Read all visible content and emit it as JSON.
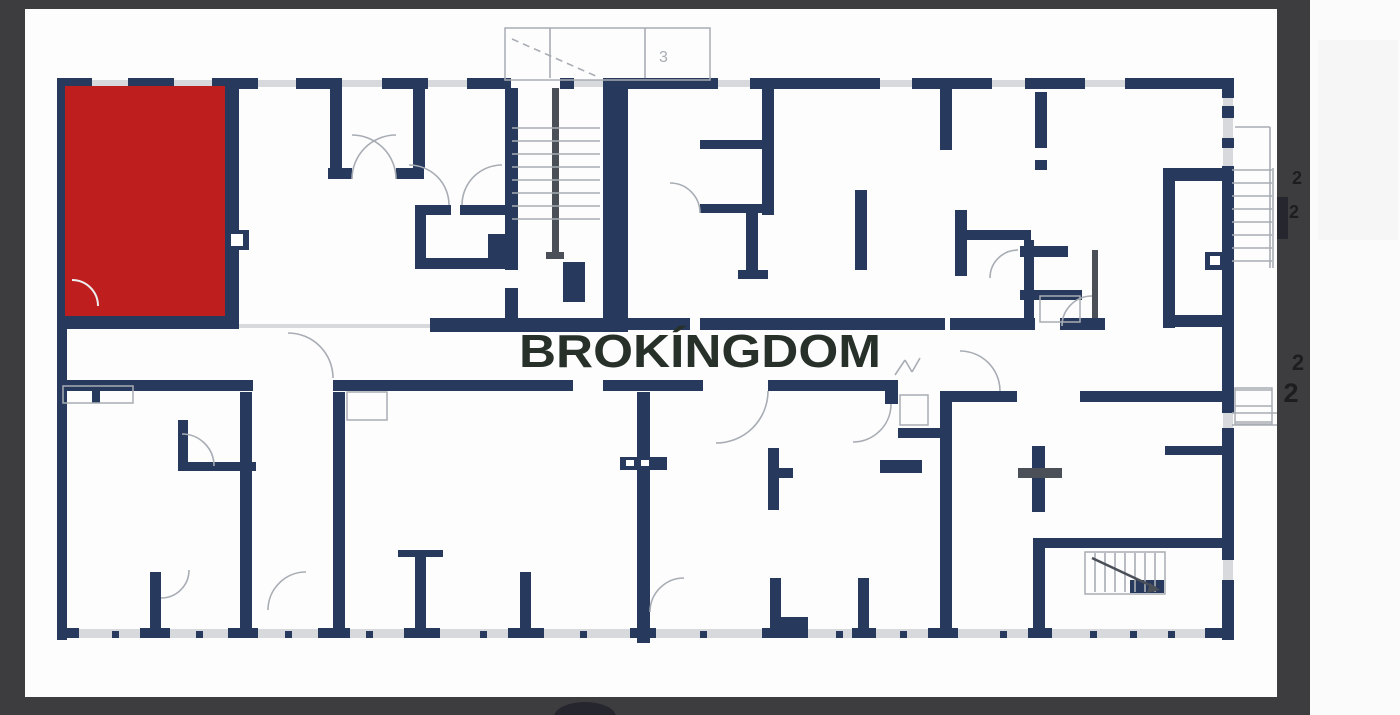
{
  "watermark": {
    "text": "BROKÍNGDOM",
    "x": 700,
    "y": 367,
    "size": 46,
    "length": 362
  },
  "labels": {
    "canopy_mark": {
      "text": "3",
      "x": 659,
      "y": 62,
      "size": 16
    },
    "dimension_marks": [
      {
        "text": "2",
        "x": 1297,
        "y": 184,
        "size": 18
      },
      {
        "text": "2",
        "x": 1294,
        "y": 218,
        "size": 18
      },
      {
        "text": "2",
        "x": 1298,
        "y": 370,
        "size": 22
      },
      {
        "text": "2",
        "x": 1291,
        "y": 402,
        "size": 27
      }
    ]
  },
  "colors": {
    "frame": "#3d3d40",
    "white_strip": "#fbfbfc",
    "plan_bg": "#fdfdfe",
    "faint": "#f6f6f7",
    "navy": "#27395d",
    "red": "#bf1e1f",
    "gray": "#a8adb4",
    "lgray": "#d7d9dc",
    "dgray": "#4a4f58",
    "ink": "#1d1d20",
    "wm": "#273129",
    "blob": "#26262e",
    "white": "#ffffff",
    "red_arc": "#eceded"
  },
  "frame": {
    "rects": [
      [
        0,
        0,
        1400,
        715,
        "white_strip"
      ],
      [
        25,
        9,
        1252,
        688,
        "plan_bg"
      ],
      [
        0,
        0,
        1310,
        9,
        "frame"
      ],
      [
        0,
        0,
        25,
        715,
        "frame"
      ],
      [
        0,
        697,
        1310,
        18,
        "frame"
      ],
      [
        1277,
        0,
        33,
        715,
        "frame"
      ],
      [
        1318,
        40,
        80,
        200,
        "faint"
      ],
      [
        1277,
        197,
        11,
        42,
        "blob"
      ]
    ],
    "blob": {
      "cx": 585,
      "cy": 717,
      "rx": 31,
      "ry": 15
    }
  },
  "plan": {
    "red_unit": {
      "x": 65,
      "y": 86,
      "w": 160,
      "h": 230
    },
    "gray_rects": [
      [
        57,
        629,
        1177,
        9
      ],
      [
        92,
        80,
        36,
        7
      ],
      [
        174,
        80,
        38,
        7
      ],
      [
        258,
        80,
        38,
        7
      ],
      [
        342,
        80,
        40,
        7
      ],
      [
        428,
        80,
        39,
        7
      ],
      [
        574,
        80,
        54,
        7
      ],
      [
        718,
        80,
        32,
        7
      ],
      [
        880,
        80,
        32,
        7
      ],
      [
        992,
        80,
        33,
        7
      ],
      [
        1085,
        80,
        40,
        7
      ],
      [
        58,
        250,
        9,
        22
      ],
      [
        58,
        452,
        9,
        22
      ],
      [
        58,
        592,
        9,
        24
      ],
      [
        1223,
        98,
        10,
        68
      ],
      [
        1223,
        413,
        10,
        15
      ],
      [
        1223,
        560,
        10,
        20
      ],
      [
        239,
        324,
        196,
        4
      ]
    ],
    "navy_rects": [
      [
        57,
        78,
        35,
        11
      ],
      [
        128,
        78,
        46,
        11
      ],
      [
        212,
        78,
        46,
        11
      ],
      [
        296,
        78,
        46,
        11
      ],
      [
        382,
        78,
        46,
        11
      ],
      [
        467,
        78,
        44,
        11
      ],
      [
        560,
        78,
        14,
        11
      ],
      [
        628,
        78,
        90,
        11
      ],
      [
        750,
        78,
        130,
        11
      ],
      [
        912,
        78,
        80,
        11
      ],
      [
        1025,
        78,
        60,
        11
      ],
      [
        1125,
        78,
        107,
        11
      ],
      [
        57,
        78,
        10,
        562
      ],
      [
        1222,
        78,
        12,
        20
      ],
      [
        1222,
        106,
        12,
        12
      ],
      [
        1222,
        138,
        12,
        10
      ],
      [
        1222,
        166,
        12,
        247
      ],
      [
        1222,
        428,
        12,
        132
      ],
      [
        1222,
        580,
        12,
        60
      ],
      [
        57,
        628,
        22,
        10
      ],
      [
        140,
        628,
        30,
        10
      ],
      [
        228,
        628,
        30,
        10
      ],
      [
        318,
        628,
        32,
        10
      ],
      [
        404,
        628,
        36,
        10
      ],
      [
        508,
        628,
        36,
        10
      ],
      [
        630,
        628,
        26,
        10
      ],
      [
        762,
        628,
        46,
        10
      ],
      [
        852,
        628,
        24,
        10
      ],
      [
        928,
        628,
        30,
        10
      ],
      [
        1028,
        628,
        24,
        10
      ],
      [
        1205,
        628,
        29,
        10
      ],
      [
        112,
        631,
        7,
        7
      ],
      [
        196,
        631,
        7,
        7
      ],
      [
        285,
        631,
        7,
        7
      ],
      [
        366,
        631,
        7,
        7
      ],
      [
        480,
        631,
        7,
        7
      ],
      [
        580,
        631,
        7,
        7
      ],
      [
        700,
        631,
        7,
        7
      ],
      [
        836,
        631,
        7,
        7
      ],
      [
        900,
        631,
        7,
        7
      ],
      [
        1000,
        631,
        7,
        7
      ],
      [
        1090,
        631,
        7,
        7
      ],
      [
        1130,
        631,
        7,
        7
      ],
      [
        1168,
        631,
        7,
        7
      ],
      [
        225,
        86,
        14,
        230
      ],
      [
        57,
        316,
        182,
        13
      ],
      [
        140,
        86,
        12,
        46
      ],
      [
        118,
        240,
        10,
        40
      ],
      [
        65,
        274,
        58,
        9
      ],
      [
        225,
        230,
        24,
        20
      ],
      [
        330,
        88,
        12,
        80
      ],
      [
        413,
        88,
        12,
        80
      ],
      [
        328,
        168,
        24,
        11
      ],
      [
        396,
        168,
        28,
        11
      ],
      [
        415,
        205,
        36,
        10
      ],
      [
        460,
        205,
        48,
        10
      ],
      [
        415,
        205,
        11,
        64
      ],
      [
        415,
        258,
        95,
        11
      ],
      [
        488,
        234,
        20,
        24
      ],
      [
        505,
        88,
        13,
        182
      ],
      [
        505,
        288,
        13,
        42
      ],
      [
        603,
        78,
        25,
        254
      ],
      [
        430,
        318,
        198,
        14
      ],
      [
        563,
        262,
        22,
        40
      ],
      [
        762,
        88,
        12,
        127
      ],
      [
        700,
        140,
        62,
        9
      ],
      [
        700,
        204,
        74,
        9
      ],
      [
        746,
        213,
        12,
        60
      ],
      [
        738,
        270,
        30,
        9
      ],
      [
        855,
        190,
        12,
        80
      ],
      [
        940,
        88,
        12,
        62
      ],
      [
        955,
        210,
        12,
        66
      ],
      [
        955,
        230,
        76,
        10
      ],
      [
        1024,
        240,
        10,
        80
      ],
      [
        1020,
        246,
        48,
        11
      ],
      [
        1020,
        290,
        62,
        10
      ],
      [
        1035,
        92,
        12,
        56
      ],
      [
        1035,
        160,
        12,
        10
      ],
      [
        1163,
        168,
        62,
        13
      ],
      [
        1163,
        168,
        12,
        160
      ],
      [
        1205,
        252,
        20,
        18
      ],
      [
        628,
        318,
        62,
        12
      ],
      [
        700,
        318,
        245,
        12
      ],
      [
        950,
        318,
        85,
        12
      ],
      [
        1060,
        318,
        45,
        12
      ],
      [
        1163,
        315,
        64,
        12
      ],
      [
        57,
        380,
        196,
        11
      ],
      [
        333,
        380,
        240,
        11
      ],
      [
        603,
        380,
        100,
        11
      ],
      [
        768,
        380,
        117,
        11
      ],
      [
        885,
        380,
        13,
        24
      ],
      [
        940,
        391,
        77,
        11
      ],
      [
        1080,
        391,
        142,
        11
      ],
      [
        240,
        392,
        12,
        236
      ],
      [
        333,
        392,
        12,
        236
      ],
      [
        637,
        392,
        13,
        251
      ],
      [
        620,
        457,
        47,
        13
      ],
      [
        768,
        448,
        11,
        62
      ],
      [
        779,
        468,
        14,
        10
      ],
      [
        770,
        578,
        11,
        50
      ],
      [
        770,
        617,
        38,
        11
      ],
      [
        858,
        578,
        11,
        55
      ],
      [
        940,
        392,
        12,
        236
      ],
      [
        1032,
        446,
        13,
        66
      ],
      [
        1165,
        446,
        57,
        9
      ],
      [
        1033,
        538,
        190,
        10
      ],
      [
        1033,
        548,
        12,
        80
      ],
      [
        1130,
        580,
        34,
        13
      ],
      [
        880,
        460,
        42,
        13
      ],
      [
        92,
        386,
        8,
        17
      ],
      [
        178,
        420,
        10,
        42
      ],
      [
        178,
        462,
        78,
        9
      ],
      [
        150,
        572,
        11,
        56
      ],
      [
        415,
        556,
        11,
        72
      ],
      [
        398,
        550,
        45,
        7
      ],
      [
        520,
        572,
        11,
        56
      ],
      [
        898,
        428,
        44,
        10
      ]
    ],
    "dark_rects": [
      [
        552,
        88,
        7,
        140
      ],
      [
        552,
        228,
        7,
        30
      ],
      [
        546,
        252,
        18,
        7
      ],
      [
        1018,
        468,
        44,
        10
      ],
      [
        1092,
        250,
        6,
        68
      ]
    ],
    "white_rects": [
      [
        626,
        460,
        8,
        6
      ],
      [
        641,
        460,
        8,
        6
      ],
      [
        1210,
        256,
        10,
        9
      ],
      [
        231,
        234,
        12,
        12
      ]
    ],
    "outlines": [
      [
        505,
        28,
        205,
        52
      ],
      [
        63,
        386,
        70,
        17
      ],
      [
        347,
        392,
        40,
        28
      ],
      [
        1040,
        296,
        40,
        26
      ],
      [
        900,
        395,
        28,
        30
      ],
      [
        1085,
        552,
        80,
        42
      ],
      [
        1235,
        388,
        37,
        36
      ]
    ],
    "lines": [
      [
        512,
        128,
        600,
        128
      ],
      [
        512,
        141,
        600,
        141
      ],
      [
        512,
        154,
        600,
        154
      ],
      [
        512,
        167,
        600,
        167
      ],
      [
        512,
        180,
        600,
        180
      ],
      [
        512,
        193,
        600,
        193
      ],
      [
        512,
        206,
        600,
        206
      ],
      [
        512,
        219,
        600,
        219
      ],
      [
        550,
        28,
        550,
        78
      ],
      [
        645,
        28,
        645,
        78
      ],
      [
        1235,
        127,
        1270,
        127
      ],
      [
        1270,
        127,
        1270,
        268
      ],
      [
        1273,
        168,
        1273,
        268
      ],
      [
        1232,
        170,
        1272,
        170
      ],
      [
        1232,
        183,
        1272,
        183
      ],
      [
        1232,
        196,
        1272,
        196
      ],
      [
        1232,
        209,
        1272,
        209
      ],
      [
        1232,
        222,
        1272,
        222
      ],
      [
        1232,
        235,
        1272,
        235
      ],
      [
        1232,
        248,
        1272,
        248
      ],
      [
        1232,
        261,
        1272,
        261
      ],
      [
        1235,
        390,
        1272,
        390
      ],
      [
        1235,
        406,
        1272,
        406
      ],
      [
        1235,
        422,
        1272,
        422
      ],
      [
        1095,
        553,
        1095,
        592
      ],
      [
        1105,
        553,
        1105,
        592
      ],
      [
        1115,
        553,
        1115,
        592
      ],
      [
        1125,
        553,
        1125,
        592
      ],
      [
        1135,
        553,
        1135,
        592
      ],
      [
        1145,
        553,
        1145,
        592
      ],
      [
        1155,
        553,
        1155,
        592
      ],
      [
        1232,
        413,
        1277,
        413
      ],
      [
        1232,
        425,
        1277,
        425
      ],
      [
        895,
        375,
        905,
        360
      ],
      [
        905,
        360,
        912,
        372
      ],
      [
        912,
        372,
        920,
        358
      ]
    ],
    "dashed_lines": [
      [
        512,
        39,
        598,
        77
      ]
    ],
    "diag": {
      "line": [
        1092,
        558,
        1156,
        588
      ],
      "arrow": "M1150 583 l10 7 -13 3 z"
    },
    "arcs": [
      "M352 179 A44 44 0 0 1 396 135",
      "M396 179 A44 44 0 0 0 352 135",
      "M449 205 A40 40 0 0 0 409 165",
      "M462 205 A40 40 0 0 1 502 165",
      "M333 378 A45 45 0 0 0 288 333",
      "M768 391 A52 52 0 0 1 716 443",
      "M891 404 A38 38 0 0 1 853 442",
      "M1000 391 A40 40 0 0 0 960 351",
      "M1018 250 A28 28 0 0 0 990 278",
      "M1092 296 A30 30 0 0 0 1062 326",
      "M214 466 A32 32 0 0 0 182 434",
      "M268 610 A38 38 0 0 1 306 572",
      "M161 598 A28 28 0 0 0 189 570",
      "M650 612 A34 34 0 0 1 684 578",
      "M700 213 A30 30 0 0 0 670 183"
    ],
    "red_arcs": [
      "M72 280 A26 26 0 0 1 98 306"
    ]
  }
}
